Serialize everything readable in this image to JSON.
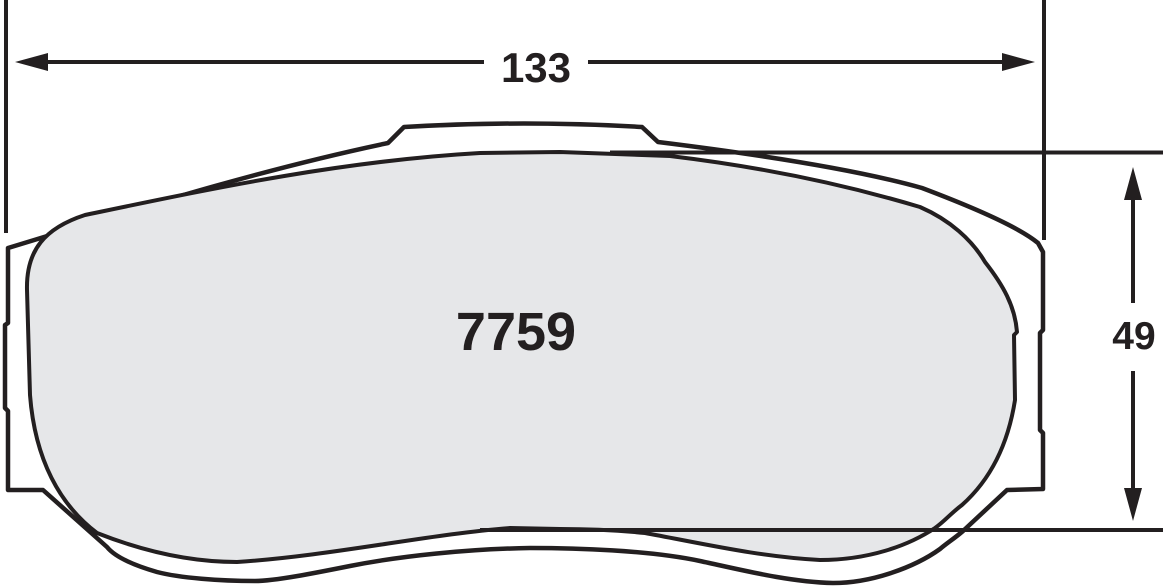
{
  "diagram": {
    "part_number": "7759",
    "width_dimension": {
      "label": "133"
    },
    "height_dimension": {
      "label": "49"
    },
    "colors": {
      "line": "#231f20",
      "friction_fill": "#e6e7e9",
      "plate_fill": "#ffffff",
      "background": "#ffffff"
    }
  }
}
